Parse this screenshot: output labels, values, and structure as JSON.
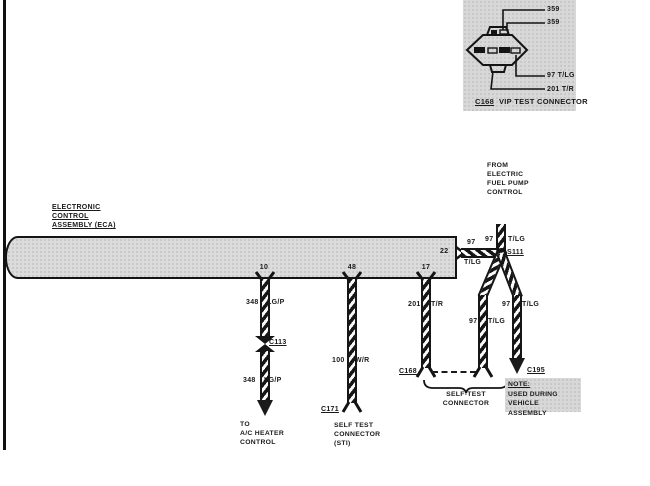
{
  "page": {
    "bg": "#ffffff",
    "ink": "#1a1a1a",
    "panel_gray": "#d8d8d8"
  },
  "vip_panel": {
    "pin_labels": [
      "359",
      "359",
      "97 T/LG",
      "201 T/R"
    ],
    "caption_code": "C168",
    "caption_title": "VIP TEST CONNECTOR"
  },
  "eca": {
    "label_lines": [
      "ELECTRONIC",
      "CONTROL",
      "ASSEMBLY (ECA)"
    ],
    "pins": [
      "10",
      "48",
      "17",
      "22"
    ]
  },
  "fuel_pump_note": {
    "lines": [
      "FROM",
      "ELECTRIC",
      "FUEL PUMP",
      "CONTROL"
    ]
  },
  "splice_label": "S111",
  "wire_ac": {
    "circuit": "348",
    "color": "LG/P",
    "connector": "C113",
    "dest": [
      "TO",
      "A/C HEATER",
      "CONTROL"
    ]
  },
  "wire_sti": {
    "circuit": "100",
    "color": "W/R",
    "connector": "C171",
    "dest": [
      "SELF TEST",
      "CONNECTOR",
      "(STI)"
    ]
  },
  "wire_201": {
    "circuit": "201",
    "color": "T/R",
    "connector": "C168"
  },
  "wire_97_from_eca": {
    "circuit": "97",
    "color": "T/LG"
  },
  "wire_97_from_pump": {
    "circuit": "97",
    "color": "T/LG"
  },
  "wire_97_left_leg": {
    "circuit": "97",
    "color": "T/LG"
  },
  "wire_97_right_leg": {
    "circuit": "97",
    "color": "T/LG",
    "connector": "C195"
  },
  "self_test_brace": {
    "lines": [
      "SELF-TEST",
      "CONNECTOR"
    ]
  },
  "note_box": {
    "lines": [
      "NOTE:",
      "USED DURING",
      "VEHICLE ASSEMBLY"
    ]
  }
}
